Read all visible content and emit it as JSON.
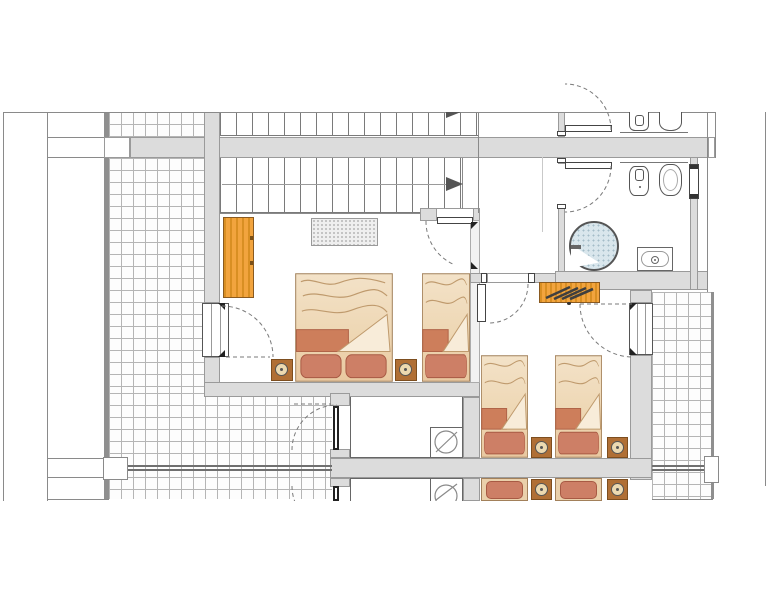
{
  "scene": {
    "kind": "architectural-floor-plan",
    "visible_text": "none"
  },
  "palette": {
    "wall": "#dcdcdc",
    "wallEdge": "#9a9a9a",
    "tileLine": "#b5b5b5",
    "darkEdge": "#8f8f8f",
    "boundary": "#8a8a8a",
    "stair": "#7a7a7a",
    "orange": "#f2a43e",
    "orangeStripe": "#d98f23",
    "orangeBorder": "#8a5a20",
    "bedOutline": "#a2805a",
    "bedLine": "#bf9a6d",
    "blanketBand": "#cd7e5b",
    "bandEdge": "#b06448",
    "fold": "#f8ecd9",
    "pillow": "#cd7f66",
    "pillowEdge": "#a85a44",
    "nightstand": "#b06f35",
    "lamp": "#ecd9b0",
    "shower": "#d9e6ec",
    "showerDot": "#a4bcc7",
    "railing": "#6f6f6f",
    "arrow": "#555555"
  },
  "furniture": {
    "beds": [
      {
        "id": "bedroom1-double-bed",
        "kind": "double",
        "x": 295,
        "y": 273,
        "w": 98,
        "h": 109
      },
      {
        "id": "bedroom1-single-bed",
        "kind": "single",
        "x": 422,
        "y": 273,
        "w": 48,
        "h": 109
      },
      {
        "id": "bedroom2-single-bed-left",
        "kind": "single",
        "x": 481,
        "y": 355,
        "w": 47,
        "h": 103
      },
      {
        "id": "bedroom2-single-bed-right",
        "kind": "single",
        "x": 555,
        "y": 355,
        "w": 47,
        "h": 103
      }
    ],
    "bed_stubs": [
      {
        "id": "mirrored-bed-left",
        "x": 481,
        "y": 478,
        "w": 47,
        "h": 23
      },
      {
        "id": "mirrored-bed-right",
        "x": 555,
        "y": 478,
        "w": 47,
        "h": 23
      }
    ],
    "nightstands": [
      {
        "id": "nightstand-1",
        "x": 271,
        "y": 359,
        "s": 22
      },
      {
        "id": "nightstand-2",
        "x": 395,
        "y": 359,
        "s": 22
      },
      {
        "id": "nightstand-3",
        "x": 531,
        "y": 437,
        "s": 21
      },
      {
        "id": "nightstand-4",
        "x": 607,
        "y": 437,
        "s": 21
      },
      {
        "id": "nightstand-5-mirrored",
        "x": 531,
        "y": 479,
        "s": 21
      },
      {
        "id": "nightstand-6-mirrored",
        "x": 607,
        "y": 479,
        "s": 21
      }
    ]
  }
}
